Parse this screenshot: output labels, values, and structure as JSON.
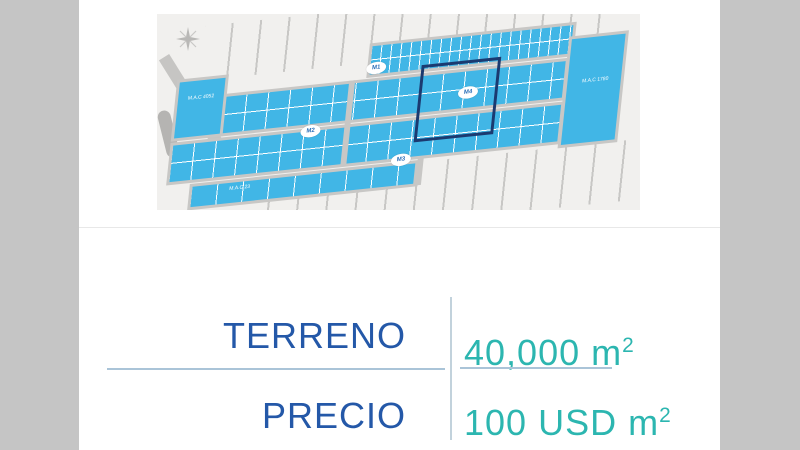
{
  "slide": {
    "pillar_color": "#c5c5c5",
    "divider_color": "#e8e8e8"
  },
  "map": {
    "colors": {
      "parcel": "#41b6e6",
      "road": "#c8c7c5",
      "background": "#f1f0ee",
      "highlight_outline": "#1b3a70"
    },
    "badges": [
      {
        "label": "M1"
      },
      {
        "label": "M2"
      },
      {
        "label": "M3"
      },
      {
        "label": "M4"
      }
    ],
    "lot_labels": {
      "left": "M.A.C 4052",
      "right": "M.A.C 1780",
      "bottom": "M.A.C 23"
    }
  },
  "details": {
    "label_color": "#2458a8",
    "value_color": "#2cb6b0",
    "rows": [
      {
        "label": "TERRENO",
        "value": "40,000 m",
        "sup": "2"
      },
      {
        "label": "PRECIO",
        "value": "100 USD m",
        "sup": "2"
      }
    ]
  }
}
